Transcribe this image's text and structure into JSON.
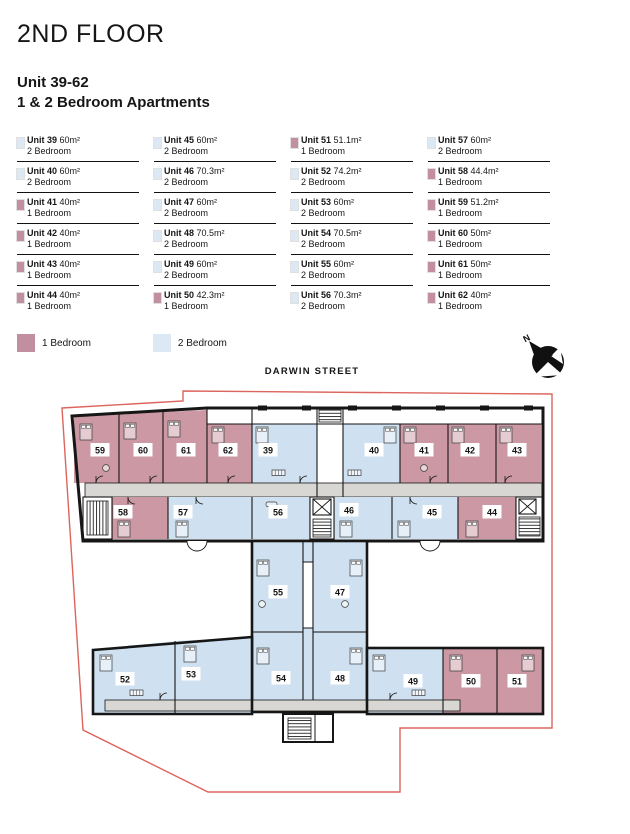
{
  "header": {
    "floor_title": "2ND FLOOR",
    "unit_range": "Unit 39-62",
    "subtitle": "1 & 2 Bedroom Apartments"
  },
  "units": [
    {
      "number": "39",
      "label": "Unit 39",
      "area": "60m²",
      "type": "2 Bedroom",
      "bed": "2"
    },
    {
      "number": "40",
      "label": "Unit 40",
      "area": "60m²",
      "type": "2 Bedroom",
      "bed": "2"
    },
    {
      "number": "41",
      "label": "Unit 41",
      "area": "40m²",
      "type": "1 Bedroom",
      "bed": "1"
    },
    {
      "number": "42",
      "label": "Unit 42",
      "area": "40m²",
      "type": "1 Bedroom",
      "bed": "1"
    },
    {
      "number": "43",
      "label": "Unit 43",
      "area": "40m²",
      "type": "1 Bedroom",
      "bed": "1"
    },
    {
      "number": "44",
      "label": "Unit 44",
      "area": "40m²",
      "type": "1 Bedroom",
      "bed": "1"
    },
    {
      "number": "45",
      "label": "Unit 45",
      "area": "60m²",
      "type": "2 Bedroom",
      "bed": "2"
    },
    {
      "number": "46",
      "label": "Unit 46",
      "area": "70.3m²",
      "type": "2 Bedroom",
      "bed": "2"
    },
    {
      "number": "47",
      "label": "Unit 47",
      "area": "60m²",
      "type": "2 Bedroom",
      "bed": "2"
    },
    {
      "number": "48",
      "label": "Unit 48",
      "area": "70.5m²",
      "type": "2 Bedroom",
      "bed": "2"
    },
    {
      "number": "49",
      "label": "Unit 49",
      "area": "60m²",
      "type": "2 Bedroom",
      "bed": "2"
    },
    {
      "number": "50",
      "label": "Unit 50",
      "area": "42.3m²",
      "type": "1 Bedroom",
      "bed": "1"
    },
    {
      "number": "51",
      "label": "Unit 51",
      "area": "51.1m²",
      "type": "1 Bedroom",
      "bed": "1"
    },
    {
      "number": "52",
      "label": "Unit 52",
      "area": "74.2m²",
      "type": "2 Bedroom",
      "bed": "2"
    },
    {
      "number": "53",
      "label": "Unit 53",
      "area": "60m²",
      "type": "2 Bedroom",
      "bed": "2"
    },
    {
      "number": "54",
      "label": "Unit 54",
      "area": "70.5m²",
      "type": "2 Bedroom",
      "bed": "2"
    },
    {
      "number": "55",
      "label": "Unit 55",
      "area": "60m²",
      "type": "2 Bedroom",
      "bed": "2"
    },
    {
      "number": "56",
      "label": "Unit 56",
      "area": "70.3m²",
      "type": "2 Bedroom",
      "bed": "2"
    },
    {
      "number": "57",
      "label": "Unit 57",
      "area": "60m²",
      "type": "2 Bedroom",
      "bed": "2"
    },
    {
      "number": "58",
      "label": "Unit 58",
      "area": "44.4m²",
      "type": "1 Bedroom",
      "bed": "1"
    },
    {
      "number": "59",
      "label": "Unit 59",
      "area": "51.2m²",
      "type": "1 Bedroom",
      "bed": "1"
    },
    {
      "number": "60",
      "label": "Unit 60",
      "area": "50m²",
      "type": "1 Bedroom",
      "bed": "1"
    },
    {
      "number": "61",
      "label": "Unit 61",
      "area": "50m²",
      "type": "1 Bedroom",
      "bed": "1"
    },
    {
      "number": "62",
      "label": "Unit 62",
      "area": "40m²",
      "type": "1 Bedroom",
      "bed": "1"
    }
  ],
  "legend": {
    "one_bed": {
      "label": "1 Bedroom",
      "color": "#c28fa0"
    },
    "two_bed": {
      "label": "2 Bedroom",
      "color": "#dce9f5"
    }
  },
  "plan": {
    "street": "DARWIN STREET",
    "north_label": "N",
    "colors": {
      "one_bed_room": "#cb98a4",
      "two_bed_room": "#cfe0f0",
      "corridor": "#d8d7d3",
      "wall": "#161616",
      "site_boundary": "#d8544b"
    }
  }
}
